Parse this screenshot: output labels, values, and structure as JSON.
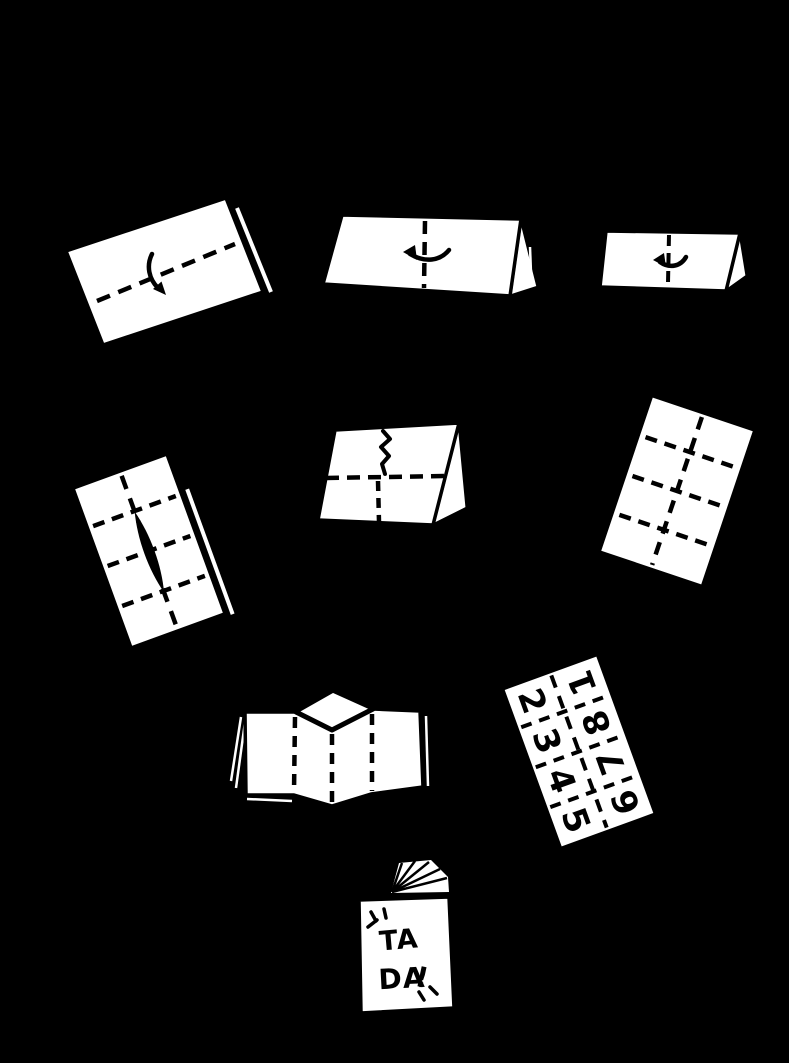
{
  "colors": {
    "background": "#000000",
    "paper": "#ffffff",
    "ink": "#000000"
  },
  "page_numbers": {
    "left_column": [
      "2",
      "3",
      "4",
      "5"
    ],
    "right_column": [
      "1",
      "8",
      "7",
      "6"
    ]
  },
  "booklet_cover": {
    "word1": "TA",
    "word2": "DA",
    "exclamation": "!"
  },
  "icons": {
    "step1_arrow": "curved-fold-down-arrow",
    "step2_arrow": "curved-fold-left-arrow",
    "step3_arrow": "curved-fold-left-arrow",
    "step5_cut": "zigzag-cut-line",
    "step9_sparkles": "sparkle-rays"
  }
}
